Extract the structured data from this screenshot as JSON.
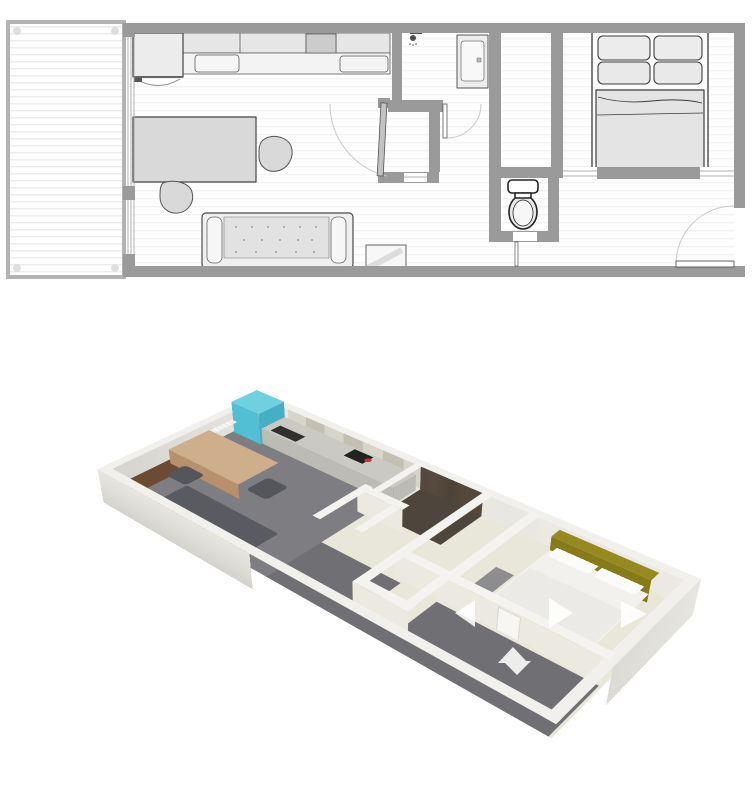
{
  "legend": {
    "views": [
      "2d-floor-plan",
      "3d-floor-plan"
    ],
    "rooms": [
      "balcony",
      "living-room",
      "kitchen",
      "hallway",
      "closet",
      "shower-room",
      "wc",
      "bedroom",
      "entry"
    ],
    "furniture": [
      "fridge",
      "kitchen-counter",
      "sink",
      "cooktop",
      "dining-table",
      "chair",
      "sofa",
      "cabinet",
      "washing-machine",
      "toilet",
      "double-bed",
      "pillows",
      "radiator",
      "dresser",
      "entry-door",
      "balcony-sliding-door"
    ],
    "icons": [
      "shower-head-icon",
      "camera-arrow-left-icon",
      "camera-arrow-right-icon",
      "camera-arrow-up-icon",
      "camera-arrow-down-icon"
    ]
  },
  "plan2d": {
    "colors": {
      "wall": "#9a9a9a",
      "wall_dark": "#8a8a8a",
      "floor": "#ffffff",
      "outline": "#4a4a4a",
      "outline_soft": "#6e6e6e",
      "furniture_fill": "#e6e6e6",
      "furniture_light": "#f3f3f3",
      "furniture_mid": "#d9d9d9",
      "appliance_dark": "#cccccc",
      "door_leaf": "#ffffff",
      "door_arc": "#c9c9c9",
      "glass_line": "#b0b0b0",
      "balcony_rail": "#b3b3b3",
      "toilet_outline": "#222222",
      "toilet_fill": "#e9e9e9"
    }
  },
  "plan3d": {
    "colors": {
      "floor_living": "#7d7d82",
      "floor_hall": "#e9e6da",
      "floor_corridor": "#6f6f74",
      "floor_shower": "#4e463c",
      "mat_wood": "#6d4a32",
      "wall_top": "#f4f3f0",
      "wall_top_outer": "#f1f0ec",
      "wall_face": "#ece9e1",
      "counter": "#cac9c3",
      "counter_side": "#bcbbb5",
      "sink": "#31302e",
      "cooktop": "#232221",
      "pot": "#c23a2e",
      "fridge_top": "#6fd0e0",
      "fridge_front": "#52bfd4",
      "fridge_side": "#46afc4",
      "table": "#cfae8c",
      "table_side": "#b8916c",
      "chair": "#55565b",
      "sofa": "#5a5b60",
      "bed": "#f2f1ee",
      "blanket": "#eceae6",
      "pillow": "#fbfbfa",
      "headboard": "#96891f",
      "headboard_side": "#877b19",
      "blanket_stripe": "#ccbc33",
      "dresser": "#8d8d90",
      "door_panel": "#f7f6f3",
      "radiator": "#f6f6f4",
      "arrow": "#ffffff"
    }
  }
}
